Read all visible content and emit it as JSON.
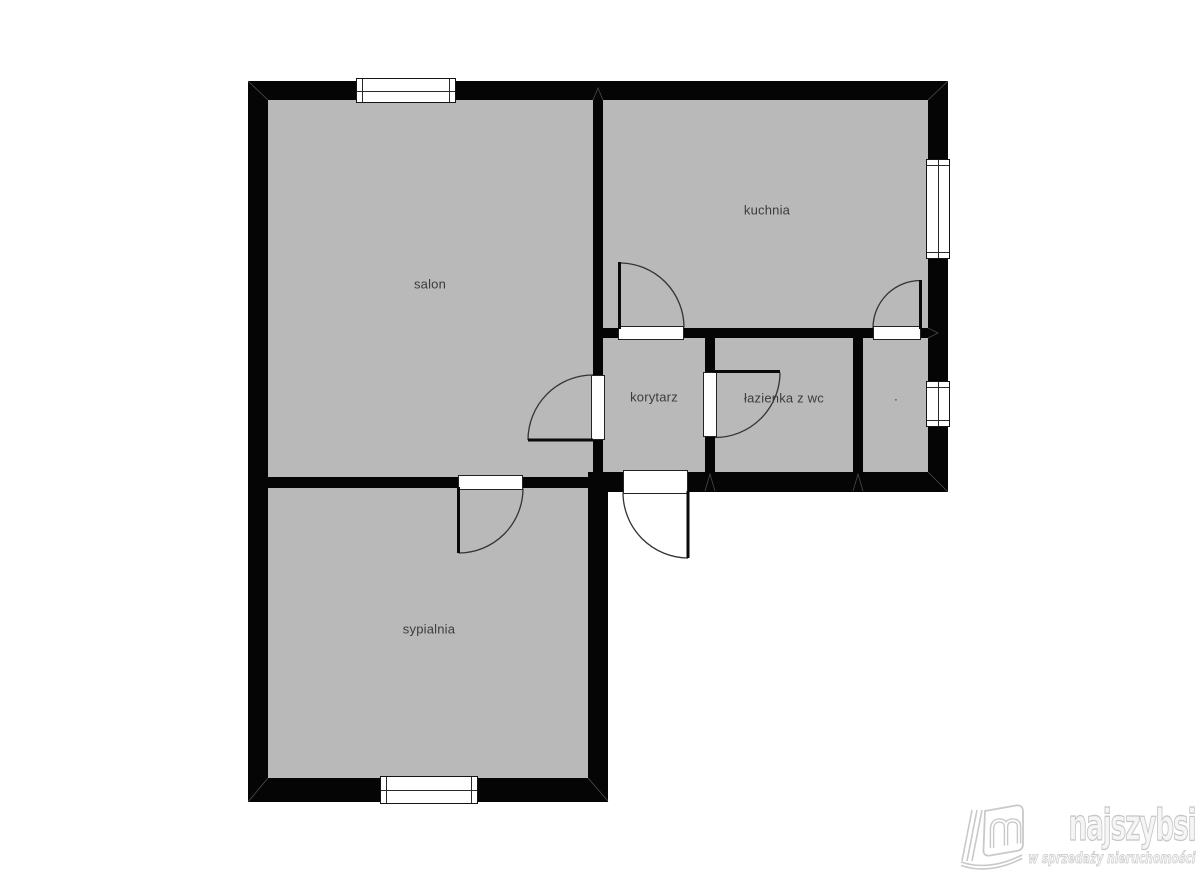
{
  "plan": {
    "rooms": [
      {
        "id": "salon",
        "label": "salon"
      },
      {
        "id": "kuchnia",
        "label": "kuchnia"
      },
      {
        "id": "korytarz",
        "label": "korytarz"
      },
      {
        "id": "lazienka",
        "label": "łazienka z wc"
      },
      {
        "id": "pokoj-dot",
        "label": "."
      },
      {
        "id": "sypialnia",
        "label": "sypialnia"
      }
    ],
    "colors": {
      "floor": "#b9b9b9",
      "wall": "#050505",
      "label_text": "#3c3c3c",
      "background": "#ffffff"
    }
  },
  "watermark": {
    "brand": "najszybsi",
    "tagline": "w sprzedaży nieruchomości",
    "color": "#c6c6c6"
  }
}
